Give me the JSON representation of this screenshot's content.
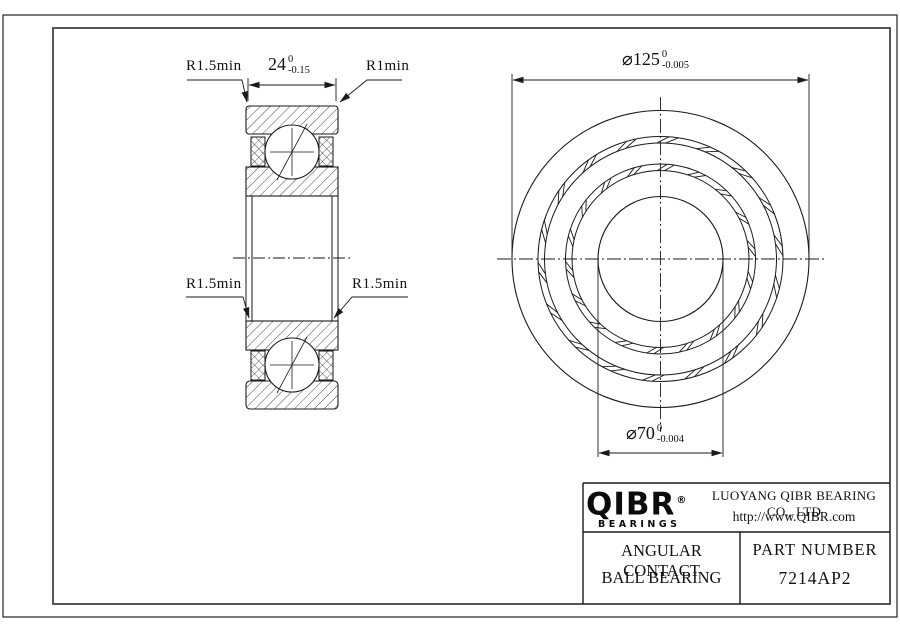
{
  "section_view": {
    "width_dim": {
      "value": "24",
      "tol_upper": "0",
      "tol_lower": "-0.15"
    },
    "leader_top_left": "R1.5min",
    "leader_top_right": "R1min",
    "leader_mid_left": "R1.5min",
    "leader_mid_right": "R1.5min"
  },
  "front_view": {
    "outer_dia": {
      "value": "⌀125",
      "tol_upper": "0",
      "tol_lower": "-0.005"
    },
    "bore_dia": {
      "value": "⌀70",
      "tol_upper": "0",
      "tol_lower": "-0.004"
    }
  },
  "title_block": {
    "logo_text": "QIBR",
    "logo_reg": "®",
    "logo_subtext": "BEARINGS",
    "company_name": "LUOYANG QIBR BEARING CO., LTD",
    "website": "http://www.QIBR.com",
    "product_name_line1": "ANGULAR CONTACT",
    "product_name_line2": "BALL BEARING",
    "part_number_label": "PART NUMBER",
    "part_number": "7214AP2"
  },
  "colors": {
    "line": "#1a1a1a",
    "background": "#ffffff"
  }
}
